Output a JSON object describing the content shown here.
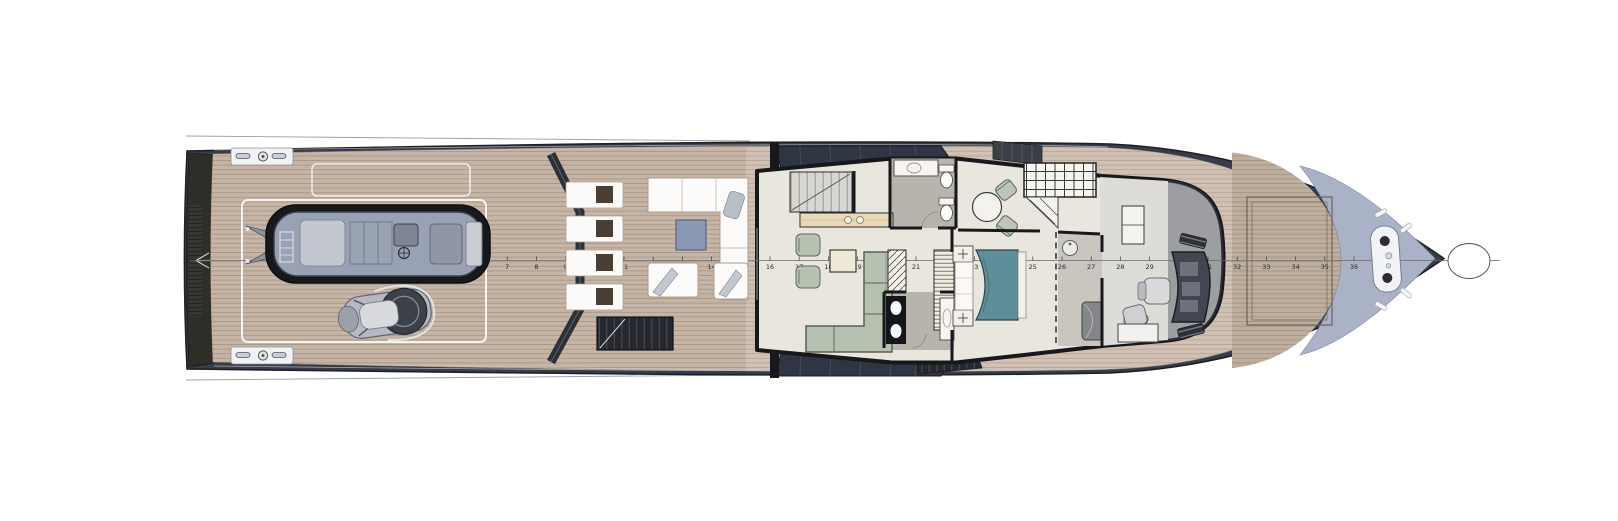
{
  "document": {
    "type": "yacht-general-arrangement-plan",
    "view": "main-deck-top-view"
  },
  "frame_ruler": {
    "start": 6,
    "end": 37,
    "numbers": [
      6,
      7,
      8,
      9,
      10,
      11,
      12,
      13,
      14,
      15,
      16,
      17,
      18,
      19,
      20,
      21,
      22,
      23,
      24,
      25,
      26,
      27,
      28,
      29,
      30,
      31,
      32,
      33,
      34,
      35,
      36,
      37
    ],
    "x_start": 478,
    "spacing": 29.2,
    "tick_height": 4,
    "label_offset_y": 8.5,
    "font_size": 6.5,
    "tick_color": "#3a3a3a",
    "label_color": "#2a2a2a",
    "centerline": {
      "x1": 190,
      "x2": 1500,
      "y": 260.5,
      "color": "#6b6b6b"
    }
  },
  "areas": [
    {
      "id": "swim-platform",
      "name": "transom swim platform"
    },
    {
      "id": "aft-deck",
      "name": "aft tender deck"
    },
    {
      "id": "lounge-deck",
      "name": "aft lounge deck"
    },
    {
      "id": "salon",
      "name": "main salon"
    },
    {
      "id": "galley",
      "name": "galley counter"
    },
    {
      "id": "day-head",
      "name": "day head"
    },
    {
      "id": "dining",
      "name": "dining nook"
    },
    {
      "id": "owner-cabin",
      "name": "owner cabin"
    },
    {
      "id": "ensuite-bathroom",
      "name": "en-suite bathroom"
    },
    {
      "id": "master-bathroom",
      "name": "master bathroom"
    },
    {
      "id": "wheelhouse",
      "name": "wheelhouse"
    },
    {
      "id": "foredeck-sunpad",
      "name": "foredeck sunpad"
    },
    {
      "id": "bow-deck",
      "name": "bow anchor deck"
    }
  ],
  "equipment": [
    {
      "id": "tender",
      "name": "tender RIB"
    },
    {
      "id": "jet-ski",
      "name": "personal watercraft"
    },
    {
      "id": "windlass-plate",
      "name": "anchor windlass plate"
    },
    {
      "id": "mooring-cleats",
      "name": "mooring cleats"
    },
    {
      "id": "helm-console",
      "name": "helm console"
    },
    {
      "id": "captain-chair",
      "name": "captain chair"
    }
  ],
  "colors": {
    "hull": "#363c49",
    "deck_side": "#d1c1b4",
    "deck_aft": "#c6b5a7",
    "deck_fore": "#beae9f",
    "bow_deck": "#aab2c7",
    "interior_floor": "#e9e6dd",
    "wet_floor": "#b8b4ac",
    "sofa_sage": "#b6c0b0",
    "bed_teal": "#5e8e97",
    "coffee_table_blue": "#8b98b4",
    "glazing_band": "#2f3542",
    "lounger_cushion": "#4a3f35",
    "stair_dark": "#26282d"
  }
}
